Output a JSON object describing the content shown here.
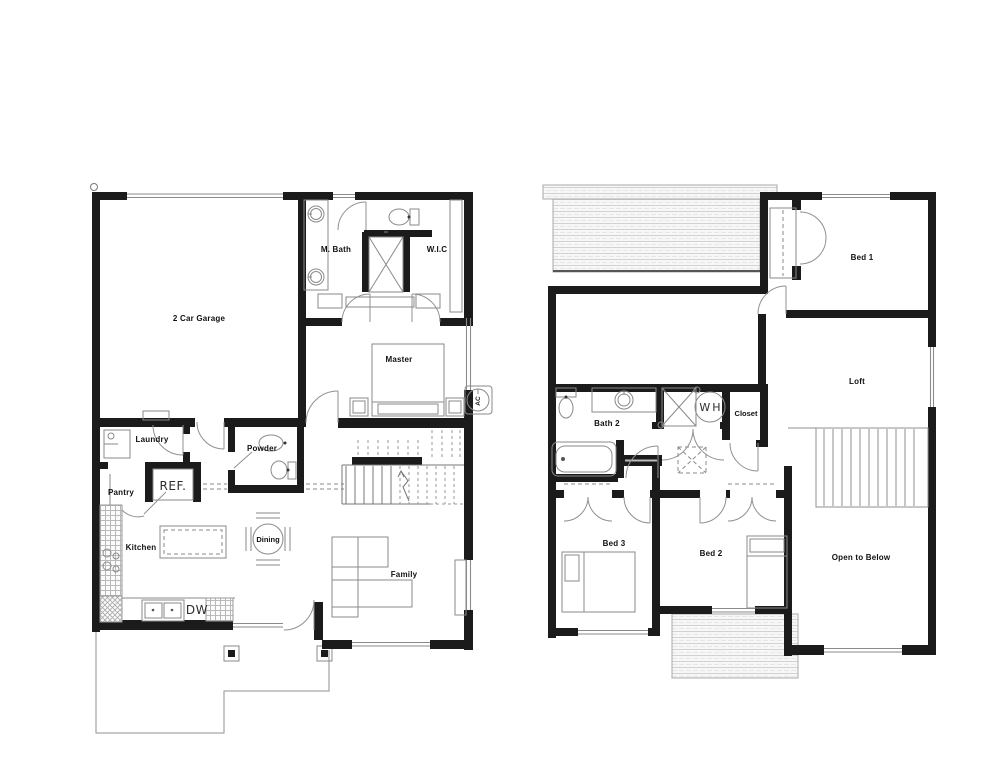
{
  "colors": {
    "wall": "#1b1b1b",
    "thin_line": "#777777",
    "hatch": "#c9c9c9",
    "text": "#111111",
    "background": "#ffffff"
  },
  "floor1": {
    "labels": {
      "garage": "2 Car Garage",
      "m_bath": "M. Bath",
      "wic": "W.I.C",
      "master": "Master",
      "laundry": "Laundry",
      "powder": "Powder",
      "pantry": "Pantry",
      "ref": "REF.",
      "kitchen": "Kitchen",
      "dining": "Dining",
      "family": "Family",
      "dw": "DW",
      "ac": "AC"
    }
  },
  "floor2": {
    "labels": {
      "bed1": "Bed 1",
      "loft": "Loft",
      "bath2": "Bath 2",
      "wh": "WH",
      "closet": "Closet",
      "bed3": "Bed 3",
      "bed2": "Bed 2",
      "open_to_below": "Open to Below"
    }
  }
}
